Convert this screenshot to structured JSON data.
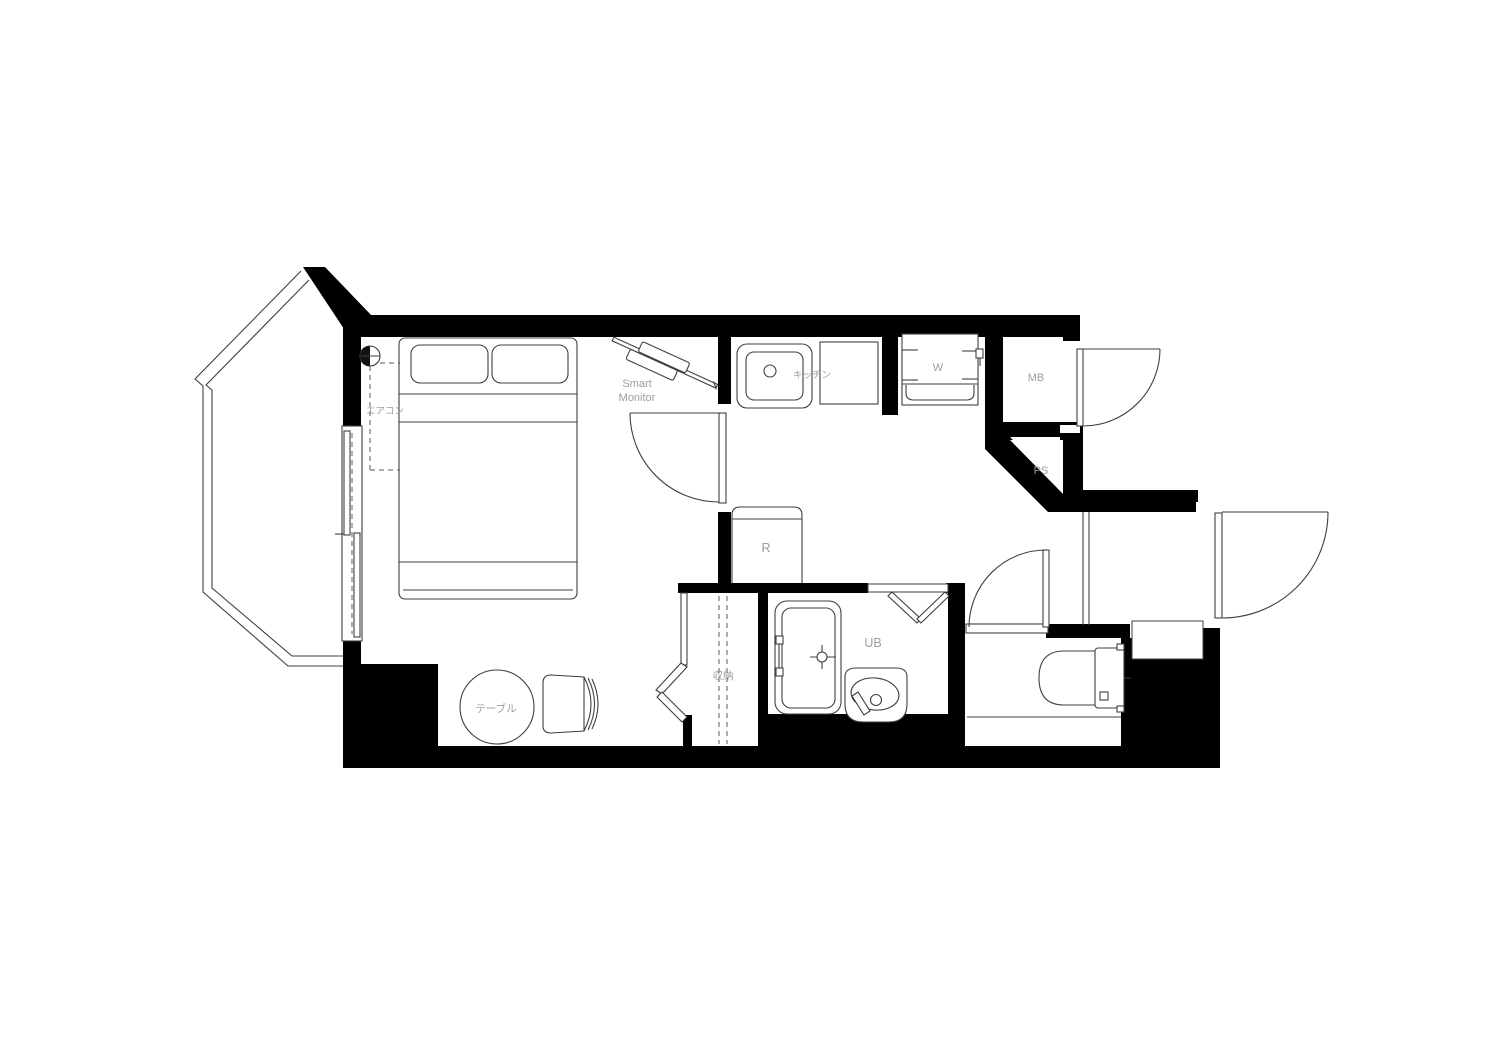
{
  "plan": {
    "type": "apartment-floor-plan",
    "labels": {
      "aircon": "エアコン",
      "smart_monitor_line1": "Smart",
      "smart_monitor_line2": "Monitor",
      "kitchen": "キッチン",
      "washer": "W",
      "meter_box": "MB",
      "pipe_space": "PS",
      "refrigerator": "R",
      "unit_bath": "UB",
      "storage": "収納",
      "table": "テーブル"
    },
    "colors": {
      "wall": "#000000",
      "line": "#3f3f3f",
      "label": "#9d9d9d",
      "background": "#ffffff"
    }
  }
}
